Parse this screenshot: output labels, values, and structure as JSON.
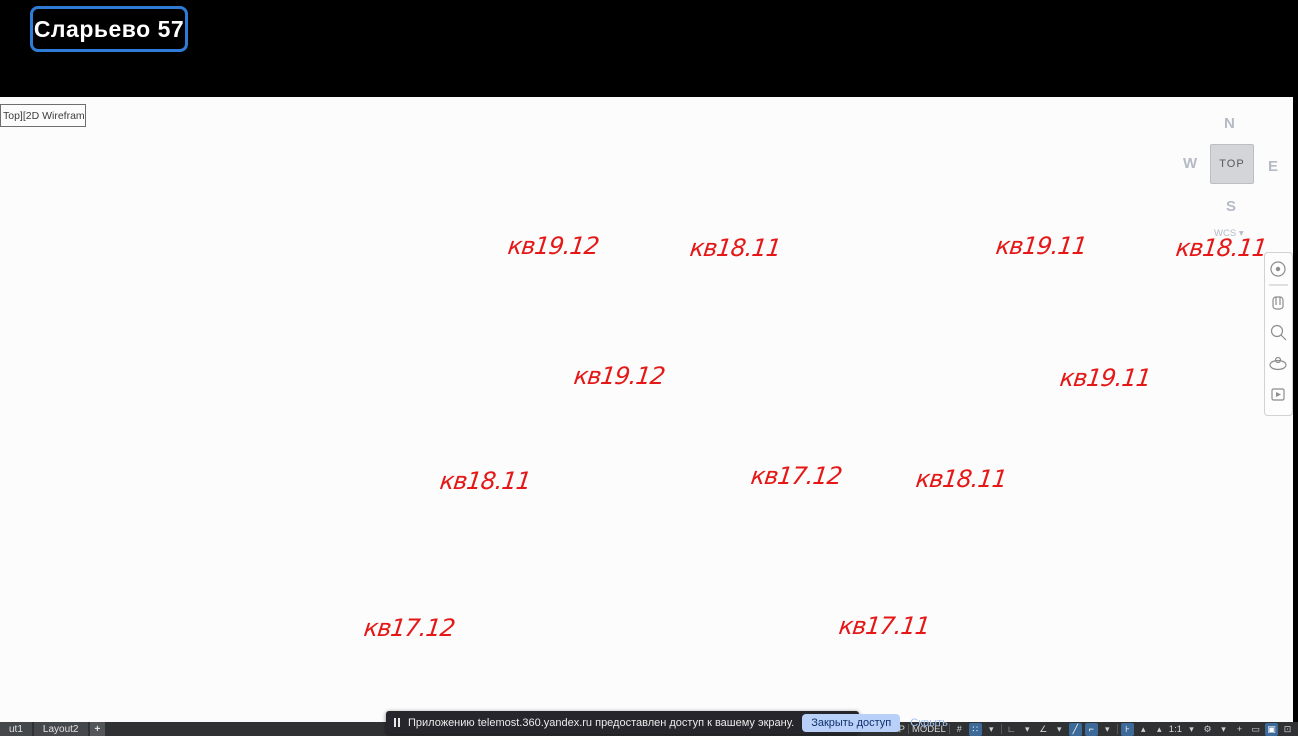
{
  "screen_share_badge": {
    "label": "Сларьево 57"
  },
  "viewport_control": {
    "label": "Top][2D Wireframe]"
  },
  "annotations": {
    "labels": [
      {
        "text": "кв19.12"
      },
      {
        "text": "кв18.11"
      },
      {
        "text": "кв19.12"
      },
      {
        "text": "кв19.11"
      },
      {
        "text": "кв18.11"
      },
      {
        "text": "кв19.11"
      },
      {
        "text": "кв18.11"
      },
      {
        "text": "кв17.12"
      },
      {
        "text": "кв17.12"
      },
      {
        "text": "кв18.11"
      },
      {
        "text": "кв17.11"
      }
    ]
  },
  "viewcube": {
    "north": "N",
    "west": "W",
    "east": "E",
    "south": "S",
    "top_face": "TOP",
    "wcs": "WCS",
    "wcs_caret": "▾"
  },
  "layout_tabs": {
    "tabs": [
      {
        "label": "ut1"
      },
      {
        "label": "Layout2"
      },
      {
        "label": "+"
      }
    ]
  },
  "status_bar": {
    "workspace_left": "ПИК",
    "workspace_right": "AP",
    "space": "MODEL",
    "items": [
      {
        "name": "grid-display-icon",
        "glyph": "#"
      },
      {
        "name": "snap-mode-icon",
        "glyph": "∷",
        "active": true
      },
      {
        "name": "snap-caret-icon",
        "glyph": "▾"
      },
      {
        "name": "sep"
      },
      {
        "name": "infer-constraints-icon",
        "glyph": "∟"
      },
      {
        "name": "infer-caret-icon",
        "glyph": "▾"
      },
      {
        "name": "polar-tracking-icon",
        "glyph": "∠"
      },
      {
        "name": "polar-caret-icon",
        "glyph": "▾"
      },
      {
        "name": "object-snap-icon",
        "glyph": "╱",
        "active": true
      },
      {
        "name": "osnap-ref-icon",
        "glyph": "⌐",
        "active": true
      },
      {
        "name": "osnap-caret-icon",
        "glyph": "▾"
      },
      {
        "name": "sep"
      },
      {
        "name": "dynamic-input-icon",
        "glyph": "⊦",
        "active": true
      },
      {
        "name": "annotation-visibility-icon",
        "glyph": "▴"
      },
      {
        "name": "annotation-autoscale-icon",
        "glyph": "▴"
      },
      {
        "name": "scale-label",
        "text": "1:1"
      },
      {
        "name": "scale-caret-icon",
        "glyph": "▾"
      },
      {
        "name": "settings-gear-icon",
        "glyph": "⚙"
      },
      {
        "name": "gear-caret-icon",
        "glyph": "▾"
      },
      {
        "name": "isolate-objects-icon",
        "glyph": "+"
      },
      {
        "name": "graphics-performance-icon",
        "glyph": "▭"
      },
      {
        "name": "clean-screen-icon",
        "glyph": "▣",
        "active": true
      },
      {
        "name": "fullscreen-icon",
        "glyph": "⊡"
      }
    ]
  },
  "notification_toast": {
    "message": "Приложению telemost.360.yandex.ru предоставлен доступ к вашему экрану.",
    "close_access_button": "Закрыть доступ",
    "hide_button": "Скрыть"
  },
  "colors": {
    "annotation_red": "#e51717",
    "badge_border": "#2e7cd6",
    "panel_blue": "#9aa2cc",
    "toast_button_bg": "#b9d1f8",
    "active_tool_blue": "#3d6a99"
  }
}
